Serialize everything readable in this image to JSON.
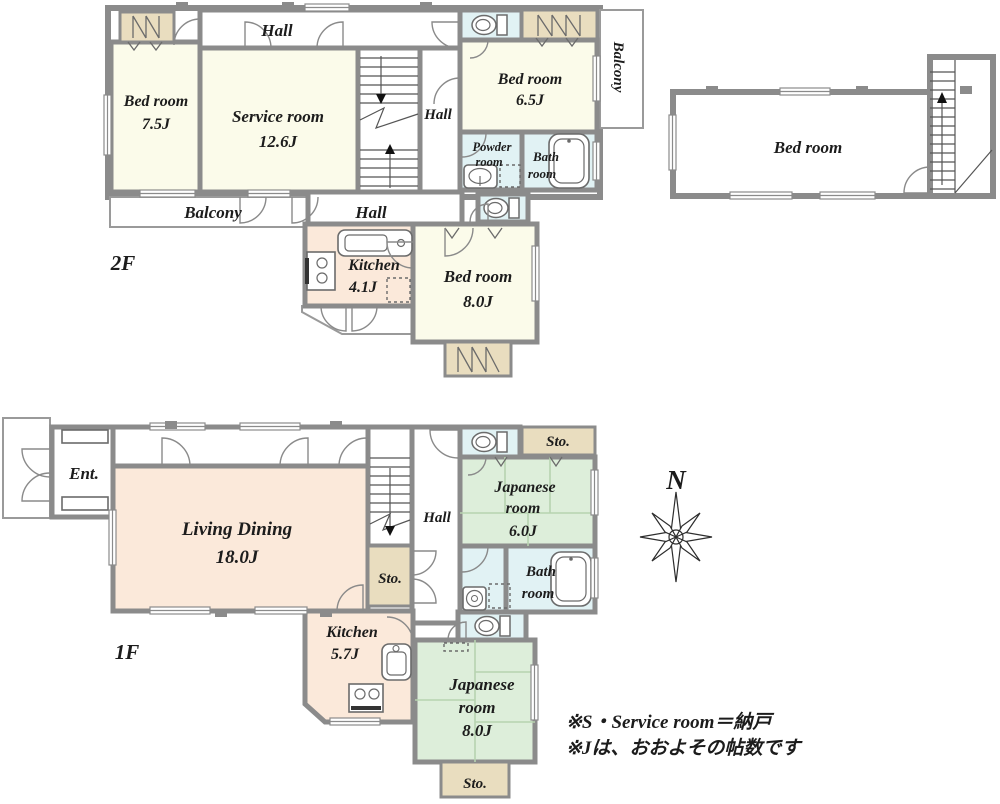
{
  "floor2": {
    "label": "2F",
    "bedroom75": {
      "name": "Bed room",
      "size": "7.5J"
    },
    "service": {
      "name": "Service room",
      "size": "12.6J"
    },
    "hall_top": "Hall",
    "hall_right": "Hall",
    "hall_lower": "Hall",
    "balcony_bottom": "Balcony",
    "balcony_right": "Balcony",
    "bedroom65": {
      "name": "Bed room",
      "size": "6.5J"
    },
    "powder": {
      "line1": "Powder",
      "line2": "room"
    },
    "bath": {
      "line1": "Bath",
      "line2": "room"
    },
    "kitchen": {
      "name": "Kitchen",
      "size": "4.1J"
    },
    "bedroom80": {
      "name": "Bed room",
      "size": "8.0J"
    },
    "bedroom_right": {
      "name": "Bed room"
    }
  },
  "floor1": {
    "label": "1F",
    "entrance": "Ent.",
    "living": {
      "name": "Living Dining",
      "size": "18.0J"
    },
    "hall": "Hall",
    "sto_stairs": "Sto.",
    "sto_ne": "Sto.",
    "sto_south": "Sto.",
    "japanese6": {
      "line1": "Japanese",
      "line2": "room",
      "size": "6.0J"
    },
    "bath": {
      "line1": "Bath",
      "line2": "room"
    },
    "kitchen": {
      "name": "Kitchen",
      "size": "5.7J"
    },
    "japanese8": {
      "line1": "Japanese",
      "line2": "room",
      "size": "8.0J"
    }
  },
  "compass": {
    "label": "N"
  },
  "notes": {
    "line1": "※S・Service room＝納戸",
    "line2": "※Jは、おおよその帖数です"
  },
  "colors": {
    "wall": "#8b8b8b",
    "room_cream": "#fbfbea",
    "room_peach": "#fbe9da",
    "room_green": "#ddeeda",
    "room_blue": "#e1f2f4",
    "closet_tan": "#e9ddbf"
  }
}
